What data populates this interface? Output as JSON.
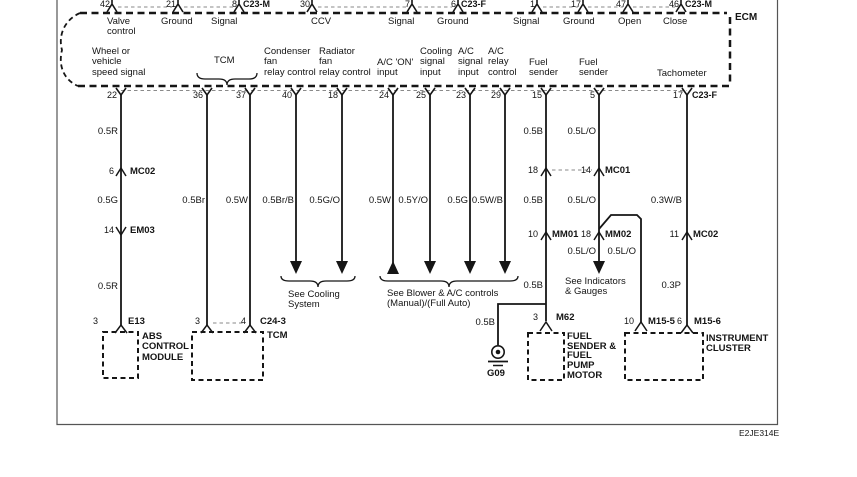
{
  "ecm": {
    "label": "ECM",
    "top": {
      "pins": [
        "42",
        "21",
        "8",
        "30",
        "7",
        "6",
        "1",
        "17",
        "47",
        "46"
      ],
      "connectors": [
        "C23-M",
        "C23-F",
        "C23-M"
      ],
      "functions": [
        "Valve\ncontrol",
        "Ground",
        "Signal",
        "CCV",
        "Signal",
        "Ground",
        "Signal",
        "Ground",
        "Open",
        "Close"
      ]
    },
    "bottom": {
      "pins": [
        "22",
        "36",
        "37",
        "40",
        "18",
        "24",
        "25",
        "23",
        "29",
        "15",
        "5",
        "17"
      ],
      "connector": "C23-F",
      "functions": [
        "Wheel or\nvehicle\nspeed signal",
        "TCM",
        "Condenser\nfan\nrelay control",
        "Radiator\nfan\nrelay control",
        "A/C 'ON'\ninput",
        "Cooling\nsignal\ninput",
        "A/C\nsignal\ninput",
        "A/C\nrelay\ncontrol",
        "Fuel\nsender",
        "Fuel\nsender",
        "Tachometer"
      ]
    }
  },
  "wire_labels": {
    "w22": [
      "0.5R",
      "0.5G",
      "0.5R"
    ],
    "w36": "0.5Br",
    "w37": "0.5W",
    "w40": "0.5Br/B",
    "w18": "0.5G/O",
    "w24": "0.5W",
    "w25": "0.5Y/O",
    "w23": "0.5G",
    "w29": "0.5W/B",
    "w15": [
      "0.5B",
      "0.5B",
      "0.5B"
    ],
    "w5": [
      "0.5L/O",
      "0.5L/O",
      "0.5L/O",
      "0.5L/O"
    ],
    "w17": [
      "0.3W/B",
      "0.3P"
    ],
    "ground_branch": "0.5B"
  },
  "inline_connectors": {
    "mc02a": {
      "pin": "6",
      "name": "MC02"
    },
    "em03": {
      "pin": "14",
      "name": "EM03"
    },
    "mc01": {
      "pin_left": "18",
      "pin_right": "14",
      "name": "MC01"
    },
    "mm01": {
      "pin": "10",
      "name": "MM01"
    },
    "mm02": {
      "pin": "18",
      "name": "MM02"
    },
    "mc02b": {
      "pin": "11",
      "name": "MC02"
    }
  },
  "components": {
    "abs": {
      "pin": "3",
      "connector": "E13",
      "label": "ABS\nCONTROL\nMODULE"
    },
    "tcm": {
      "pin_left": "3",
      "pin_right": "4",
      "connector": "C24-3",
      "label": "TCM"
    },
    "fuel": {
      "pin": "3",
      "connector": "M62",
      "label": "FUEL\nSENDER &\nFUEL\nPUMP\nMOTOR"
    },
    "cluster": {
      "pin_left": "10",
      "conn_left": "M15-5",
      "pin_right": "6",
      "conn_right": "M15-6",
      "label": "INSTRUMENT\nCLUSTER"
    },
    "ground": {
      "label": "G09"
    }
  },
  "notes": {
    "cooling": "See Cooling\nSystem",
    "blower": "See Blower & A/C controls\n(Manual)/(Full Auto)",
    "indicators": "See Indicators\n& Gauges"
  },
  "footer": {
    "code": "E2JE314E"
  }
}
